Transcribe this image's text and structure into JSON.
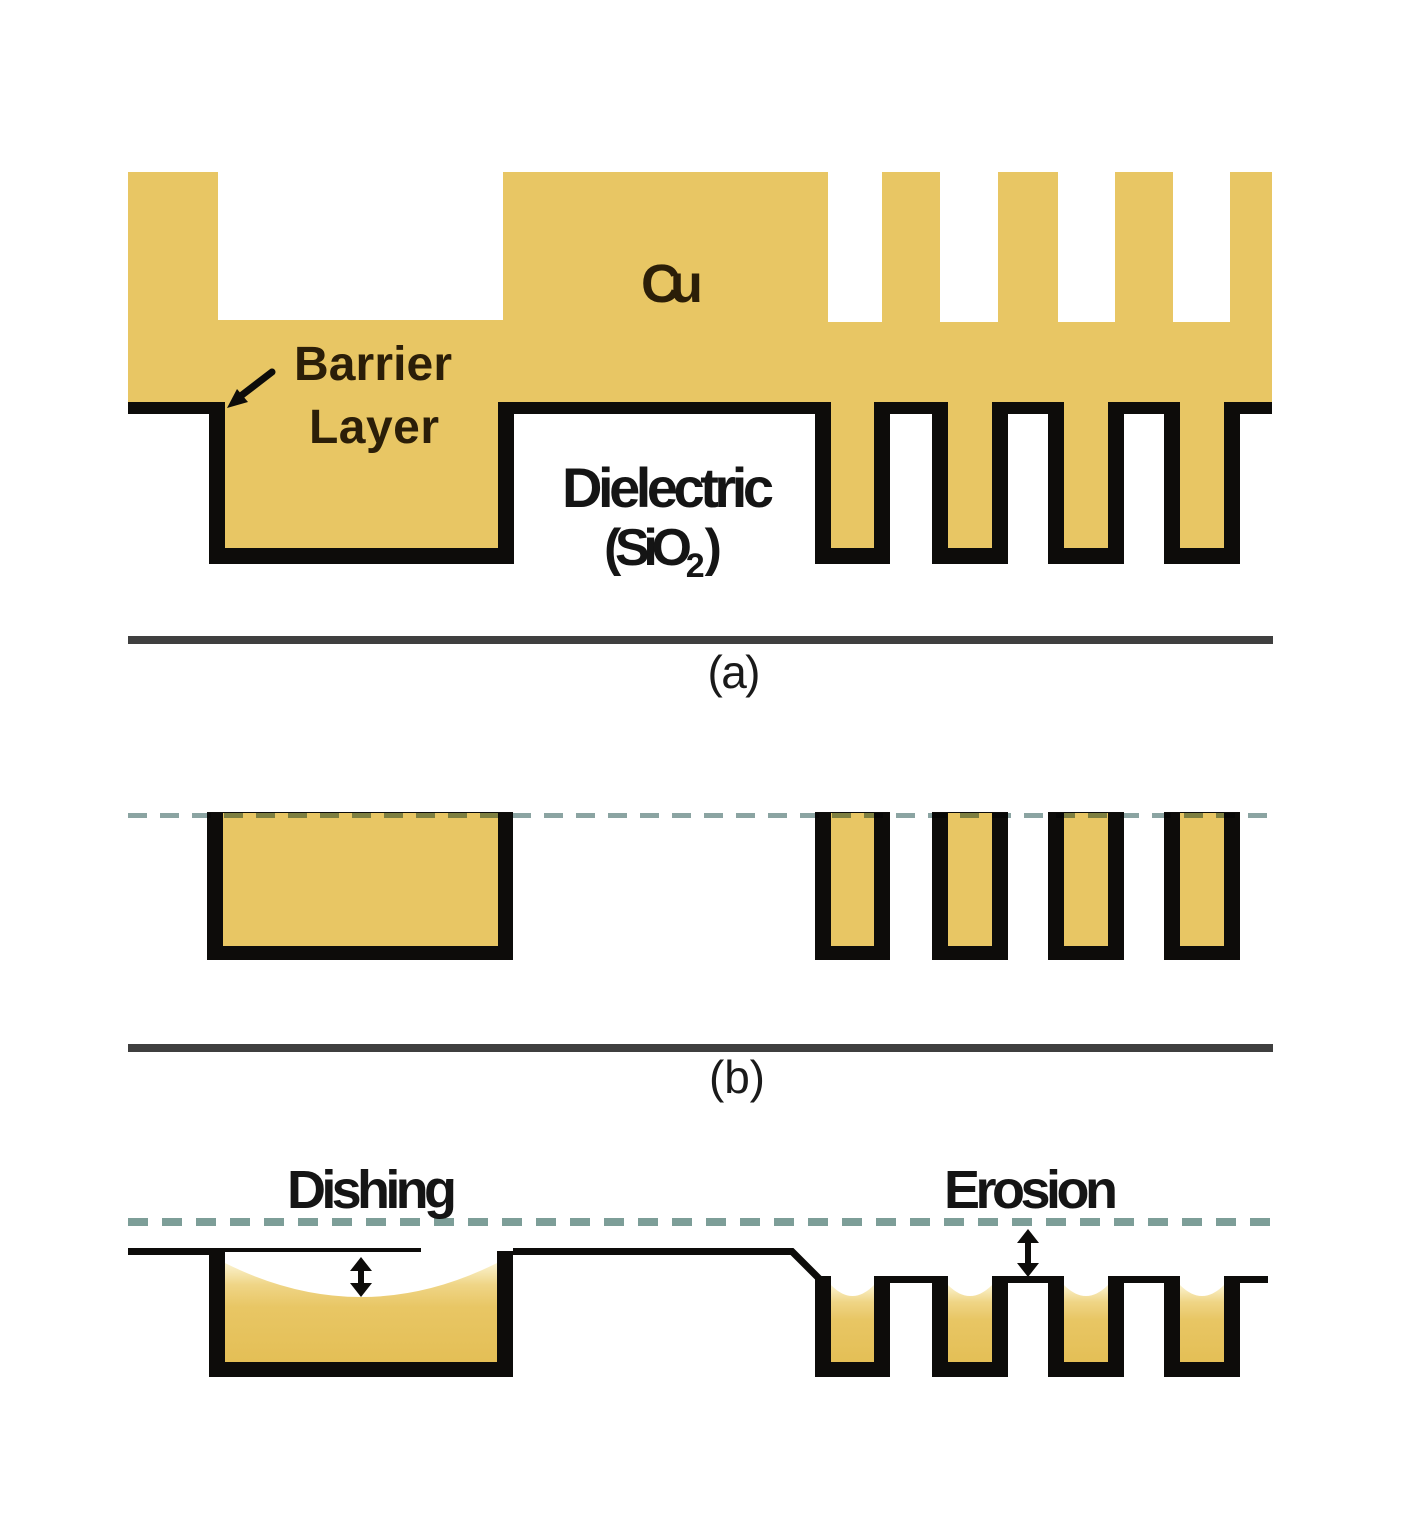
{
  "figure": {
    "panel_a": {
      "label": "(a)",
      "cu_label": "Cu",
      "barrier_label_line1": "Barrier",
      "barrier_label_line2": "Layer",
      "dielectric_label_line1": "Dielectric",
      "dielectric_label_line2_prefix": "(SiO",
      "dielectric_label_line2_sub": "2",
      "dielectric_label_line2_suffix": ")"
    },
    "panel_b": {
      "label": "(b)"
    },
    "panel_c": {
      "dishing_label": "Dishing",
      "erosion_label": "Erosion"
    },
    "colors": {
      "copper_fill": "#e8c664",
      "copper_light": "#f7ecc0",
      "barrier_black": "#0d0c0a",
      "dash_line_b": "#8ba4a2",
      "dash_line_c": "#7d9e98",
      "divider_gray": "#3f3f3f",
      "text_dark": "#2b1e08",
      "text_black": "#151515"
    }
  }
}
